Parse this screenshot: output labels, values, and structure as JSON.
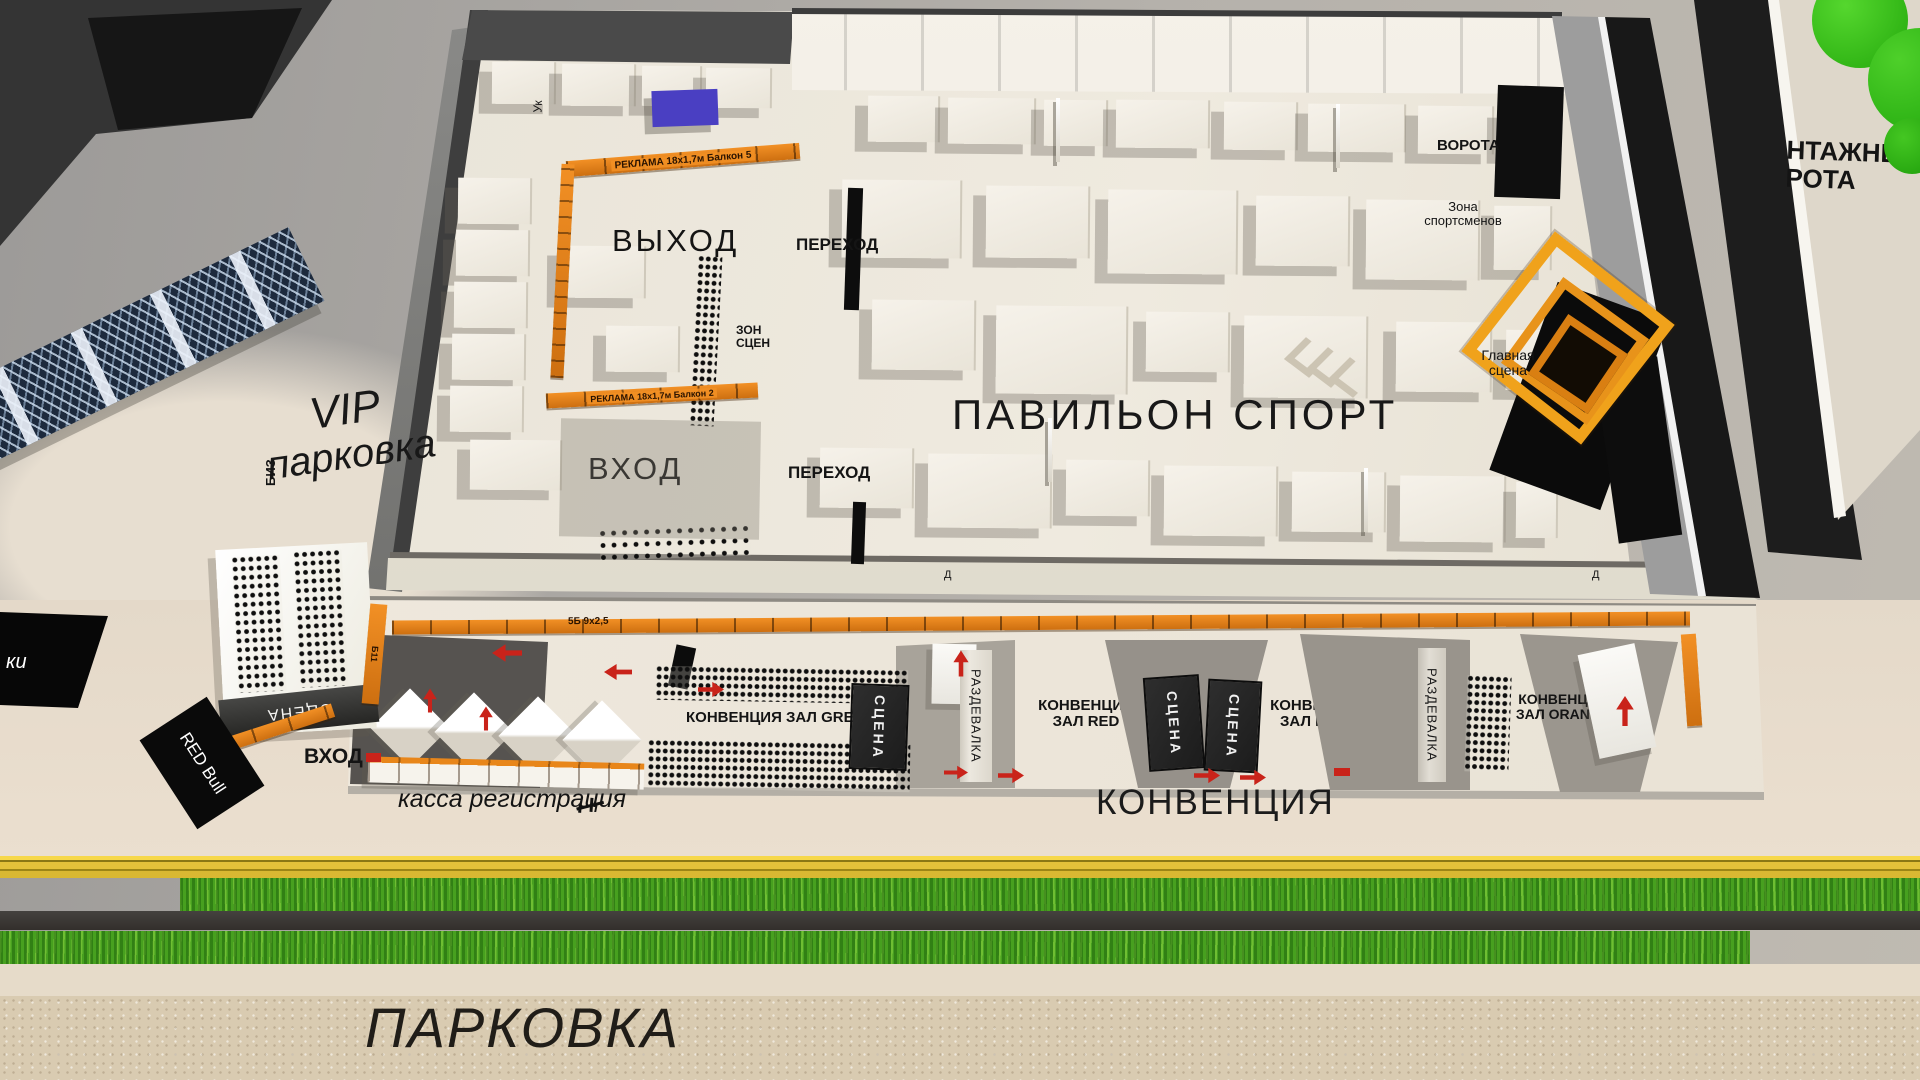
{
  "labels": {
    "pavilion_sport": "ПАВИЛЬОН СПОРТ",
    "exit": "ВЫХОД",
    "entrance": "ВХОД",
    "passage": "ПЕРЕХОД",
    "gates": "ВОРОТА",
    "athletes_zone_line1": "Зона",
    "athletes_zone_line2": "спортсменов",
    "main_stage_line1": "Главная",
    "main_stage_line2": "сцена",
    "mount_gates_line1": "НТАЖНЫЕ",
    "mount_gates_line2": "РОТА",
    "vip_line1": "VIP",
    "vip_line2": "парковка",
    "biz": "БИЗ",
    "uk": "Ук",
    "stage_box": "СЦЕНА",
    "locker_room": "РАЗДЕВАЛКА",
    "red_bull": "RED Bull",
    "ticket_office": "касса регистрация",
    "convention_big": "КОНВЕНЦИЯ",
    "parking_big": "ПАРКОВКА",
    "hall_green": "КОНВЕНЦИЯ  ЗАЛ GREEN",
    "hall_red_line1": "КОНВЕНЦИЯ",
    "hall_red_line2": "ЗАЛ RED",
    "hall_blue_line1": "КОНВЕНЦИЯ",
    "hall_blue_line2": "ЗАЛ BLUE",
    "hall_orange_line1": "КОНВЕНЦИЯ",
    "hall_orange_line2": "ЗАЛ ORANGE",
    "stage_zone_line1": "ЗОН",
    "stage_zone_line2": "СЦЕН",
    "door": "Д",
    "ki": "ки"
  },
  "banners": {
    "ad_balcony5": "РЕКЛАМА 18х1,7м  Балкон 5",
    "ad_balcony2": "РЕКЛАМА 18х1,7м Балкон 2",
    "banner_5b": "5Б 9х2,5",
    "banner_b11": "Б11"
  },
  "colors": {
    "accent_orange": "#e8861a",
    "portal_orange": "#f0a21b",
    "arrow_red": "#c9231a",
    "grass_green": "#47a01f",
    "floor_cream": "#ece7dd",
    "wall_dark": "#3f3f3f",
    "ground_gray": "#a8a6a2",
    "parking_tan": "#d9cbb1",
    "banner_black": "#0a0a0a",
    "tree_green": "#2fc013",
    "rail_yellow": "#e3c13a"
  }
}
